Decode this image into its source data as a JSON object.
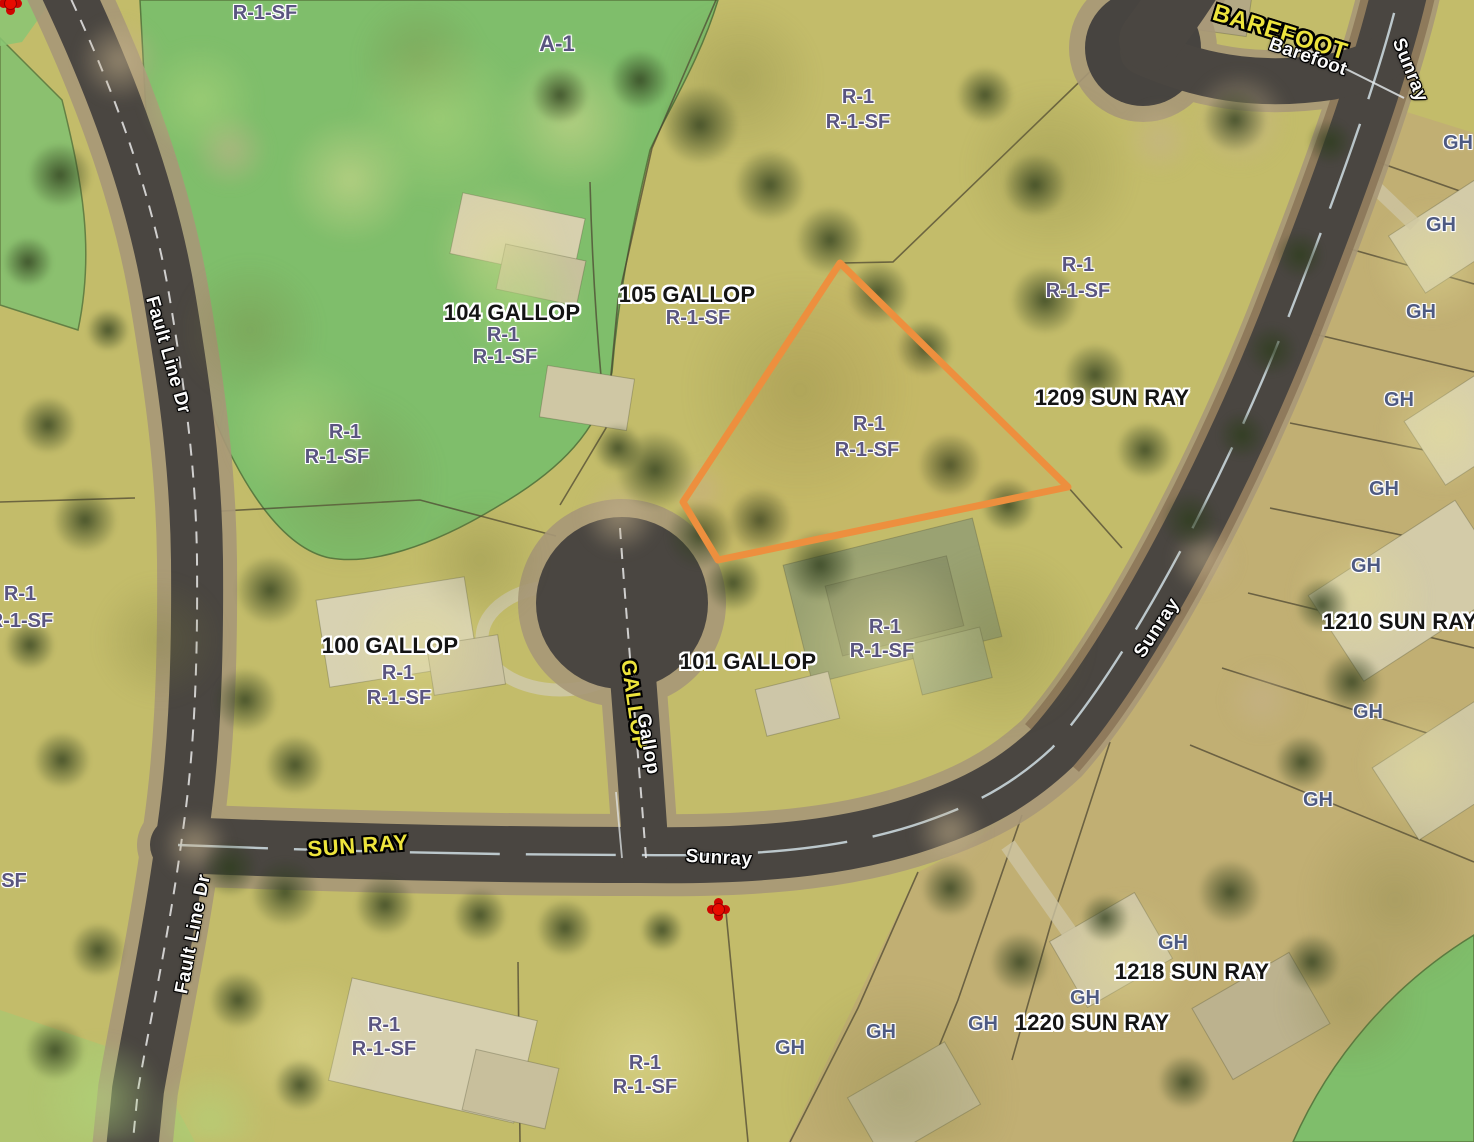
{
  "map": {
    "type": "parcel-zoning-aerial-map",
    "base_colors": {
      "land": "#c3bc6a",
      "golf_green": "#7fbe6b",
      "gh_district_tan": "#c0a977",
      "road_asphalt": "#4a4641",
      "road_shoulder": "#a89878",
      "zoning_text": "#5a5580",
      "gh_text": "#4e5a82",
      "address_text": "#141414",
      "street_primary_text": "#ede43c",
      "street_secondary_text": "#fbfbfb"
    },
    "selected_parcel": {
      "outline_color": "#ED8F3E",
      "points": "840,263 1068,487 718,560 683,502"
    },
    "labels": {
      "addresses": [
        {
          "text": "104 GALLOP",
          "x": 512,
          "y": 313
        },
        {
          "text": "105 GALLOP",
          "x": 687,
          "y": 295
        },
        {
          "text": "100 GALLOP",
          "x": 390,
          "y": 646
        },
        {
          "text": "101 GALLOP",
          "x": 748,
          "y": 662
        },
        {
          "text": "1209 SUN RAY",
          "x": 1112,
          "y": 398
        },
        {
          "text": "1210 SUN RAY",
          "x": 1400,
          "y": 622
        },
        {
          "text": "1218 SUN RAY",
          "x": 1192,
          "y": 972
        },
        {
          "text": "1220 SUN RAY",
          "x": 1092,
          "y": 1023
        }
      ],
      "zoning": [
        {
          "text": "R-1-SF",
          "x": 265,
          "y": 13
        },
        {
          "text": "A-1",
          "x": 557,
          "y": 44,
          "s": 22
        },
        {
          "text": "R-1",
          "x": 858,
          "y": 97
        },
        {
          "text": "R-1-SF",
          "x": 858,
          "y": 122
        },
        {
          "text": "R-1",
          "x": 1078,
          "y": 265
        },
        {
          "text": "R-1-SF",
          "x": 1078,
          "y": 291
        },
        {
          "text": "R-1",
          "x": 503,
          "y": 335
        },
        {
          "text": "R-1-SF",
          "x": 505,
          "y": 357
        },
        {
          "text": "R-1-SF",
          "x": 698,
          "y": 318
        },
        {
          "text": "R-1",
          "x": 345,
          "y": 432
        },
        {
          "text": "R-1-SF",
          "x": 337,
          "y": 457
        },
        {
          "text": "R-1",
          "x": 869,
          "y": 424
        },
        {
          "text": "R-1-SF",
          "x": 867,
          "y": 450
        },
        {
          "text": "R-1",
          "x": 20,
          "y": 594
        },
        {
          "text": "R-1-SF",
          "x": 21,
          "y": 621
        },
        {
          "text": "R-1",
          "x": 398,
          "y": 673
        },
        {
          "text": "R-1-SF",
          "x": 399,
          "y": 698
        },
        {
          "text": "R-1",
          "x": 885,
          "y": 627
        },
        {
          "text": "R-1-SF",
          "x": 882,
          "y": 651
        },
        {
          "text": "SF",
          "x": 14,
          "y": 881
        },
        {
          "text": "R-1",
          "x": 384,
          "y": 1025
        },
        {
          "text": "R-1-SF",
          "x": 384,
          "y": 1049
        },
        {
          "text": "R-1",
          "x": 645,
          "y": 1063
        },
        {
          "text": "R-1-SF",
          "x": 645,
          "y": 1087
        },
        {
          "text": "GH",
          "x": 1458,
          "y": 143,
          "k": "gh"
        },
        {
          "text": "GH",
          "x": 1441,
          "y": 225,
          "k": "gh"
        },
        {
          "text": "GH",
          "x": 1421,
          "y": 312,
          "k": "gh"
        },
        {
          "text": "GH",
          "x": 1399,
          "y": 400,
          "k": "gh"
        },
        {
          "text": "GH",
          "x": 1384,
          "y": 489,
          "k": "gh"
        },
        {
          "text": "GH",
          "x": 1366,
          "y": 566,
          "k": "gh"
        },
        {
          "text": "GH",
          "x": 1368,
          "y": 712,
          "k": "gh"
        },
        {
          "text": "GH",
          "x": 1318,
          "y": 800,
          "k": "gh"
        },
        {
          "text": "GH",
          "x": 1173,
          "y": 943,
          "k": "gh"
        },
        {
          "text": "GH",
          "x": 1085,
          "y": 998,
          "k": "gh"
        },
        {
          "text": "GH",
          "x": 983,
          "y": 1024,
          "k": "gh"
        },
        {
          "text": "GH",
          "x": 881,
          "y": 1032,
          "k": "gh"
        },
        {
          "text": "GH",
          "x": 790,
          "y": 1048,
          "k": "gh"
        }
      ],
      "streets_primary": [
        {
          "text": "BAREFOOT",
          "x": 1280,
          "y": 33,
          "r": 17,
          "s": 24
        },
        {
          "text": "SUN RAY",
          "x": 358,
          "y": 846,
          "r": -4,
          "s": 22
        },
        {
          "text": "GALLOP",
          "x": 634,
          "y": 705,
          "r": 82
        }
      ],
      "streets_secondary": [
        {
          "text": "Barefoot",
          "x": 1308,
          "y": 57,
          "r": 19
        },
        {
          "text": "Sunray",
          "x": 1410,
          "y": 70,
          "r": 68
        },
        {
          "text": "Fault Line Dr",
          "x": 168,
          "y": 355,
          "r": 74
        },
        {
          "text": "Fault Line Dr",
          "x": 193,
          "y": 934,
          "r": -79
        },
        {
          "text": "Sunray",
          "x": 719,
          "y": 858,
          "r": 3
        },
        {
          "text": "Sunray",
          "x": 1157,
          "y": 628,
          "r": -57
        },
        {
          "text": "Gallop",
          "x": 648,
          "y": 744,
          "r": 80
        }
      ]
    },
    "markers": [
      {
        "x": 10,
        "y": 3
      },
      {
        "x": 718,
        "y": 909
      }
    ]
  }
}
